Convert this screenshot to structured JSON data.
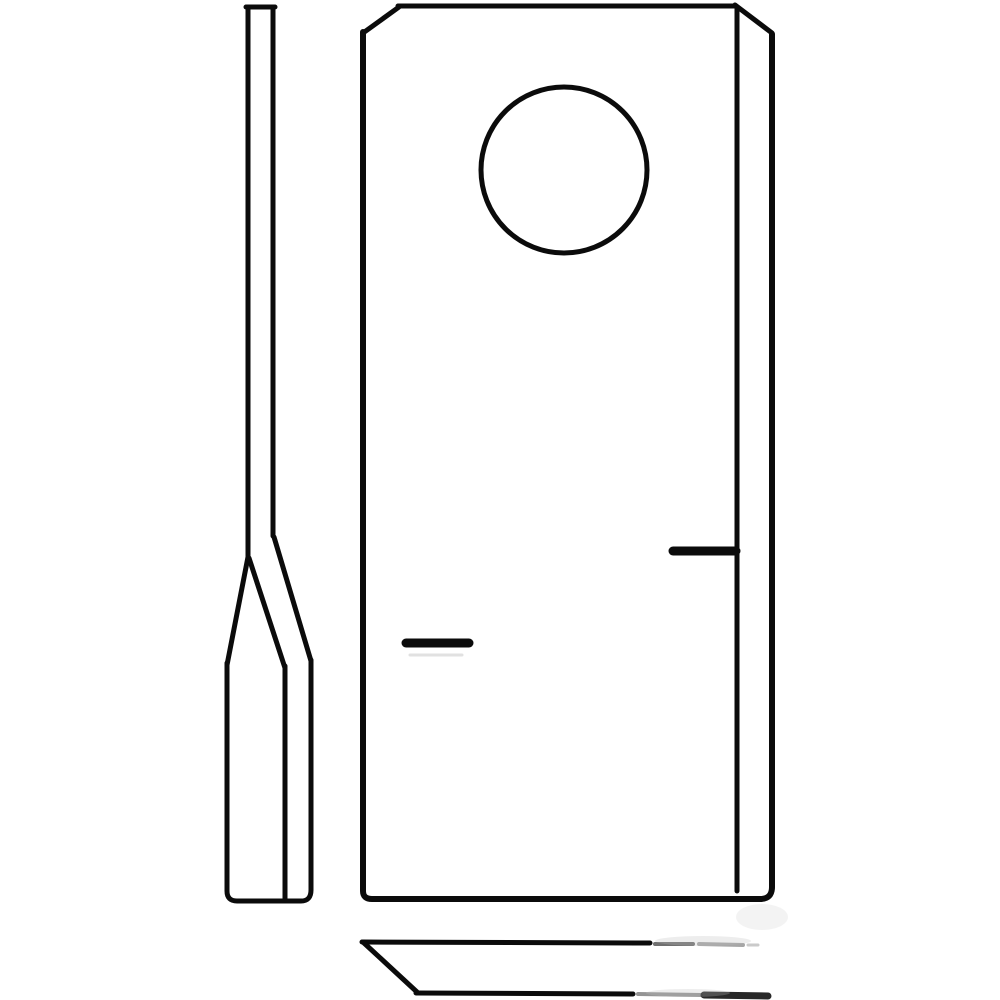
{
  "canvas": {
    "width": 1000,
    "height": 1000,
    "background_color": "#ffffff",
    "stroke_color": "#0b0b0b",
    "stroke_width": 5
  },
  "drawing": {
    "subject": "mower-blade-line-drawing",
    "views": [
      "side-profile",
      "front-view",
      "bottom-view"
    ],
    "shapes": [
      {
        "name": "side-shank-top-cap",
        "view": "side-profile",
        "type": "line",
        "x1": 246,
        "y1": 7,
        "x2": 275,
        "y2": 7
      },
      {
        "name": "side-shank-left-edge",
        "view": "side-profile",
        "type": "line",
        "x1": 248,
        "y1": 7,
        "x2": 248,
        "y2": 558
      },
      {
        "name": "side-shank-right-edge",
        "view": "side-profile",
        "type": "line",
        "x1": 273,
        "y1": 7,
        "x2": 273,
        "y2": 536
      },
      {
        "name": "side-taper-left-edge",
        "view": "side-profile",
        "type": "line",
        "x1": 248,
        "y1": 557,
        "x2": 227,
        "y2": 665
      },
      {
        "name": "side-taper-bevel-line",
        "view": "side-profile",
        "type": "line",
        "x1": 249,
        "y1": 558,
        "x2": 285,
        "y2": 668
      },
      {
        "name": "side-taper-right-edge",
        "view": "side-profile",
        "type": "line",
        "x1": 274,
        "y1": 537,
        "x2": 311,
        "y2": 661
      },
      {
        "name": "side-blade-body-outline",
        "view": "side-profile",
        "type": "path",
        "d": "M227,663 L227,891 Q227,901 237,901 L301,901 Q311,901 311,890 L311,660"
      },
      {
        "name": "side-blade-bevel-edge",
        "view": "side-profile",
        "type": "line",
        "x1": 285,
        "y1": 666,
        "x2": 285,
        "y2": 900
      },
      {
        "name": "plate-top-edge",
        "view": "front-view",
        "type": "line",
        "x1": 398,
        "y1": 6,
        "x2": 736,
        "y2": 6
      },
      {
        "name": "plate-top-left-chamfer",
        "view": "front-view",
        "type": "line",
        "x1": 363,
        "y1": 33,
        "x2": 399,
        "y2": 7
      },
      {
        "name": "plate-left-bottom-right-outline",
        "view": "front-view",
        "type": "path",
        "d": "M363,32 L363,891 Q363,899 372,899 L760,899 Q772,899 772,887 L772,34",
        "stroke_width": 6
      },
      {
        "name": "plate-top-right-chamfer",
        "view": "front-view",
        "type": "line",
        "x1": 735,
        "y1": 5,
        "x2": 772,
        "y2": 33
      },
      {
        "name": "plate-inner-right-edge",
        "view": "front-view",
        "type": "line",
        "x1": 737,
        "y1": 7,
        "x2": 737,
        "y2": 891
      },
      {
        "name": "bolt-hole",
        "view": "front-view",
        "type": "circle",
        "cx": 564,
        "cy": 170,
        "r": 83
      },
      {
        "name": "left-cutting-edge-mark",
        "view": "front-view",
        "type": "line",
        "x1": 406,
        "y1": 643,
        "x2": 469,
        "y2": 643,
        "stroke_width": 9
      },
      {
        "name": "left-cutting-edge-mark-ghost",
        "view": "front-view",
        "type": "line",
        "x1": 410,
        "y1": 655,
        "x2": 462,
        "y2": 655,
        "stroke_width": 3,
        "color": "#c9c9c9",
        "opacity": 0.55
      },
      {
        "name": "right-cutting-edge-mark",
        "view": "front-view",
        "type": "line",
        "x1": 673,
        "y1": 551,
        "x2": 736,
        "y2": 551,
        "stroke_width": 9
      },
      {
        "name": "bottom-view-top-edge",
        "view": "bottom-view",
        "type": "line",
        "x1": 362,
        "y1": 942,
        "x2": 650,
        "y2": 943
      },
      {
        "name": "bottom-view-top-edge-faded-1",
        "view": "bottom-view",
        "type": "line",
        "x1": 655,
        "y1": 944,
        "x2": 693,
        "y2": 944,
        "color": "#3f3f3f",
        "opacity": 0.75,
        "stroke_width": 4
      },
      {
        "name": "bottom-view-top-edge-faded-2",
        "view": "bottom-view",
        "type": "line",
        "x1": 699,
        "y1": 944,
        "x2": 743,
        "y2": 945,
        "color": "#5d5d5d",
        "opacity": 0.55,
        "stroke_width": 4
      },
      {
        "name": "bottom-view-top-edge-faded-3",
        "view": "bottom-view",
        "type": "line",
        "x1": 748,
        "y1": 945,
        "x2": 758,
        "y2": 945,
        "color": "#8a8a8a",
        "opacity": 0.45,
        "stroke_width": 3
      },
      {
        "name": "bottom-view-left-diagonal",
        "view": "bottom-view",
        "type": "line",
        "x1": 364,
        "y1": 943,
        "x2": 417,
        "y2": 992
      },
      {
        "name": "bottom-view-bottom-edge",
        "view": "bottom-view",
        "type": "line",
        "x1": 416,
        "y1": 993,
        "x2": 633,
        "y2": 994
      },
      {
        "name": "bottom-view-bottom-edge-faded",
        "view": "bottom-view",
        "type": "line",
        "x1": 638,
        "y1": 994,
        "x2": 701,
        "y2": 995,
        "color": "#4d4d4d",
        "opacity": 0.6,
        "stroke_width": 4
      },
      {
        "name": "bottom-view-bottom-edge-end",
        "view": "bottom-view",
        "type": "line",
        "x1": 704,
        "y1": 995,
        "x2": 768,
        "y2": 996,
        "color": "#161616",
        "opacity": 0.92,
        "stroke_width": 7
      },
      {
        "name": "watermark-smudge-upper",
        "view": "bottom-view",
        "type": "ellipse",
        "cx": 703,
        "cy": 941,
        "rx": 48,
        "ry": 5,
        "fill": "#bdbdbd",
        "opacity": 0.28
      },
      {
        "name": "watermark-smudge-lower",
        "view": "bottom-view",
        "type": "ellipse",
        "cx": 688,
        "cy": 993,
        "rx": 42,
        "ry": 4,
        "fill": "#bdbdbd",
        "opacity": 0.28
      },
      {
        "name": "watermark-smudge-corner",
        "view": "bottom-view",
        "type": "ellipse",
        "cx": 762,
        "cy": 917,
        "rx": 26,
        "ry": 13,
        "fill": "#e2e2e2",
        "opacity": 0.4
      }
    ]
  }
}
